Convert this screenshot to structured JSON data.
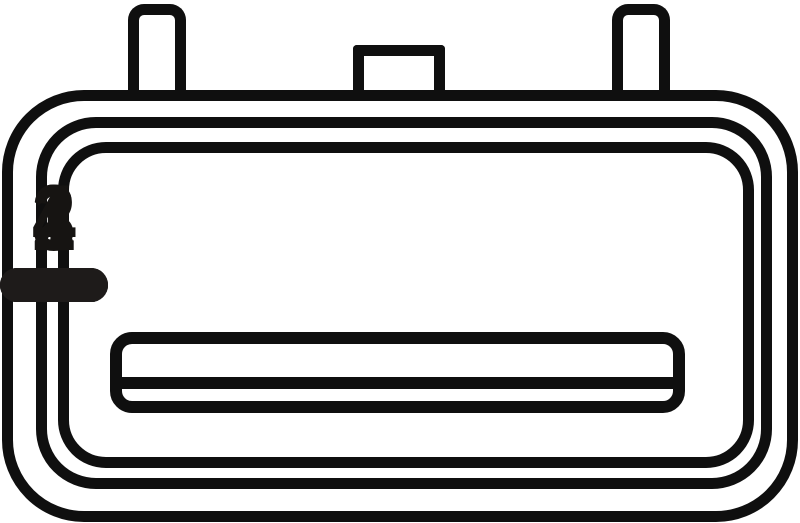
{
  "diagram": {
    "type": "electrical-connector-pinout-face-view",
    "pin_count": 4,
    "pins": [
      {
        "label": "1"
      },
      {
        "label": "2"
      },
      {
        "label": "3"
      },
      {
        "label": "4"
      }
    ],
    "colors": {
      "outline": "#0f0f0f",
      "pin_fill": "#1e1b1a",
      "background": "#ffffff",
      "label": "#161412"
    }
  }
}
